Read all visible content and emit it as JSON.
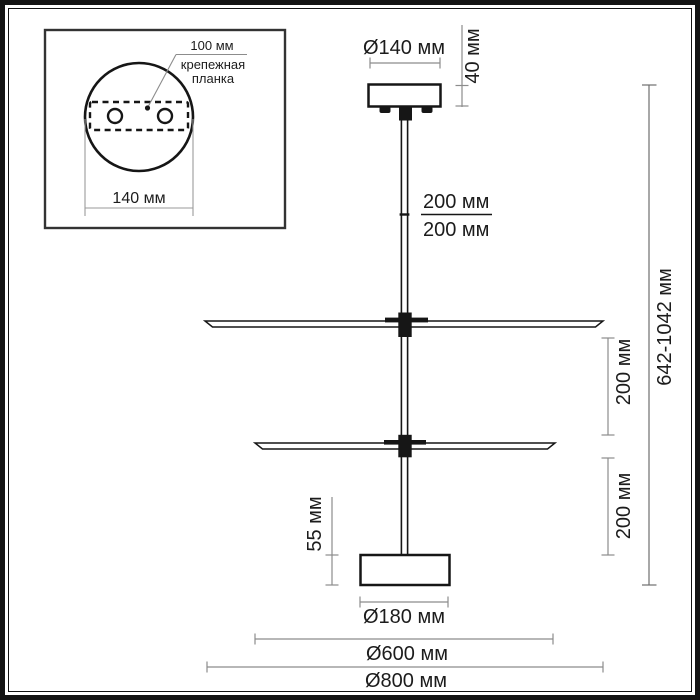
{
  "colors": {
    "ink": "#161616",
    "dimension_line": "#8c8c8c",
    "text": "#1c1c1c",
    "background": "#ffffff"
  },
  "inset": {
    "plate_offset_label": "100 мм",
    "plate_name_line1": "крепежная",
    "plate_name_line2": "планка",
    "canopy_width_label": "140 мм"
  },
  "dims": {
    "canopy_diameter": "Ø140 мм",
    "canopy_height": "40 мм",
    "rod_segment_upper": "200 мм",
    "rod_segment_lower": "200 мм",
    "overall_height": "642-1042 мм",
    "tier_spacing_upper": "200 мм",
    "tier_spacing_lower": "200 мм",
    "diffuser_height": "55 мм",
    "diffuser_diameter": "Ø180 мм",
    "lower_tier_diameter": "Ø600 мм",
    "upper_tier_diameter": "Ø800 мм"
  }
}
